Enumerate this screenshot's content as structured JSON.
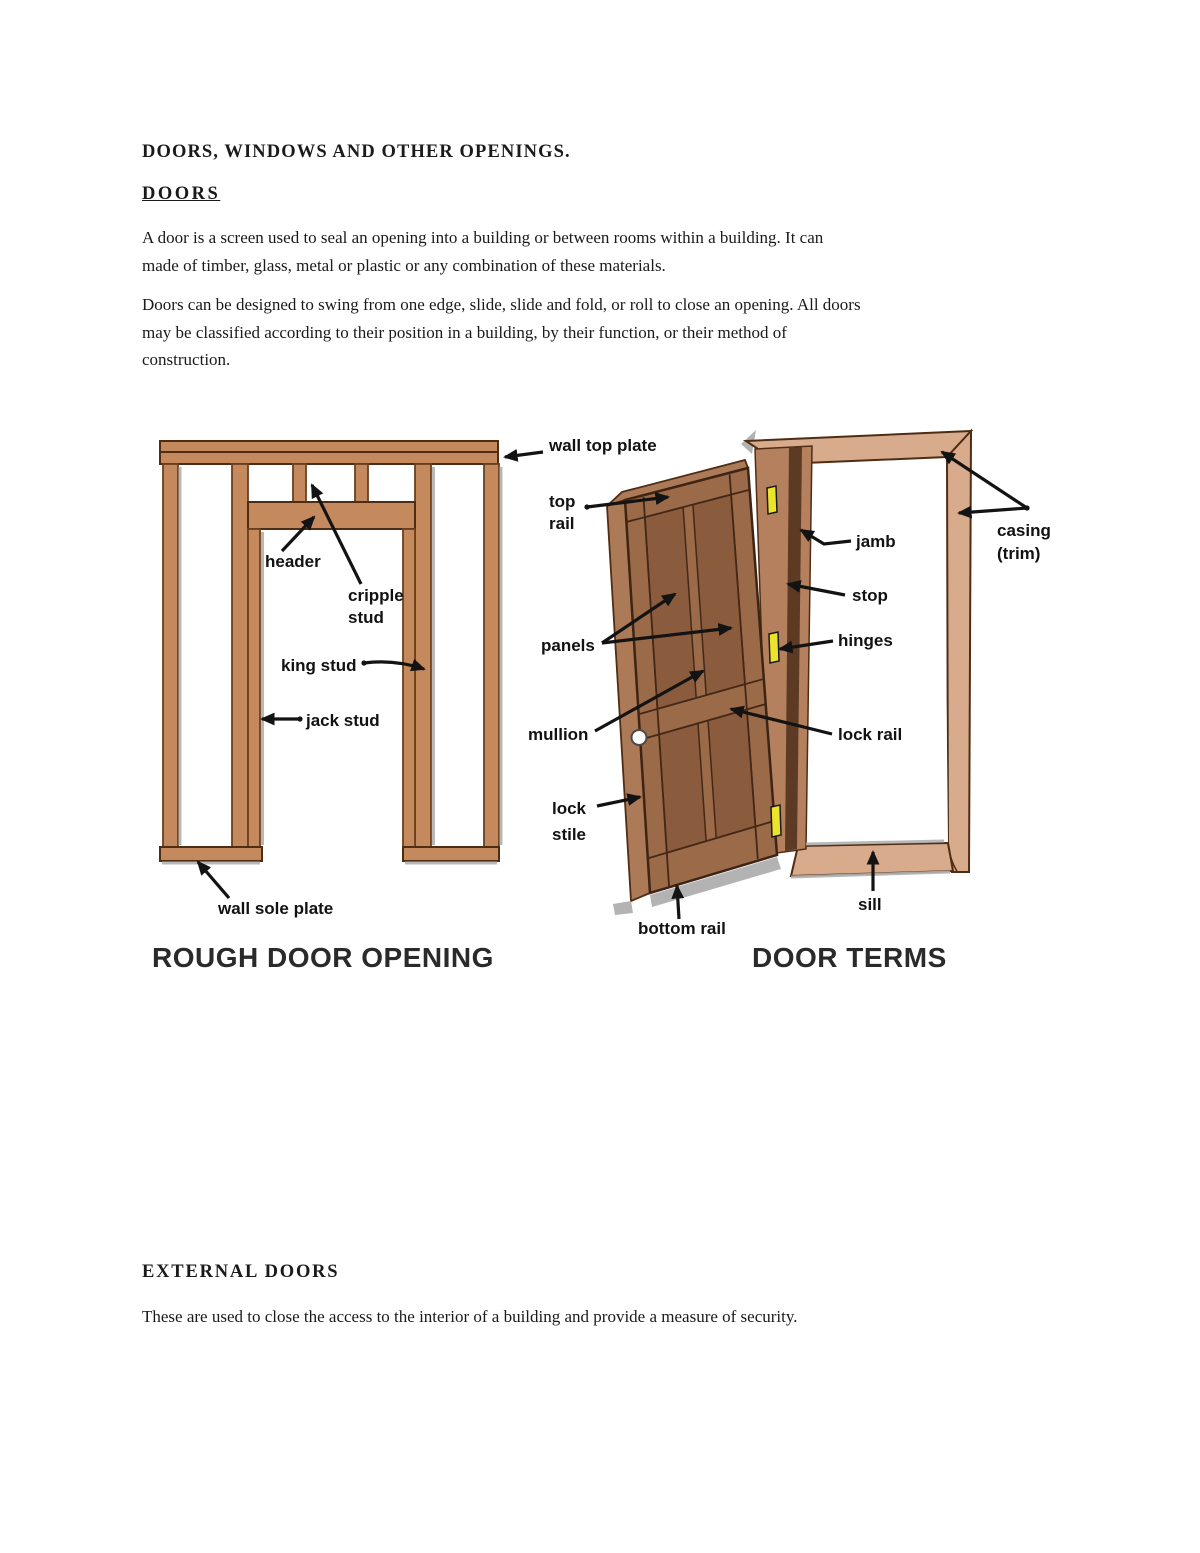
{
  "document": {
    "title": "DOORS, WINDOWS AND OTHER OPENINGS.",
    "heading_doors": "DOORS",
    "para1_lines": [
      "A door is a screen used to seal an opening into a building or between rooms within a building. It can",
      "made of timber, glass, metal or plastic or any combination of these materials."
    ],
    "para2_lines": [
      "Doors can be designed to swing from one edge, slide, slide and fold, or roll to close an opening. All doors",
      "may be classified according to their position in a building, by their function, or their method of",
      "construction."
    ],
    "heading_external": "EXTERNAL DOORS",
    "para3_lines": [
      "These are used to close the access to the interior of a building and provide a measure of security."
    ]
  },
  "figures": {
    "rough_door_opening": {
      "caption": "ROUGH DOOR OPENING",
      "labels": {
        "wall_top_plate": "wall top plate",
        "header": "header",
        "cripple_stud_line1": "cripple",
        "cripple_stud_line2": "stud",
        "king_stud": "king stud",
        "jack_stud": "jack stud",
        "wall_sole_plate": "wall sole plate"
      }
    },
    "door_terms": {
      "caption": "DOOR TERMS",
      "labels": {
        "top_rail_line1": "top",
        "top_rail_line2": "rail",
        "jamb": "jamb",
        "stop": "stop",
        "hinges": "hinges",
        "casing_line1": "casing",
        "casing_line2": "(trim)",
        "panels": "panels",
        "mullion": "mullion",
        "lock_rail": "lock rail",
        "lock_stile_line1": "lock",
        "lock_stile_line2": "stile",
        "bottom_rail": "bottom rail",
        "sill": "sill"
      }
    },
    "colors": {
      "stud_wood": "#c4895c",
      "casing_wood": "#d9ab8d",
      "jamb_wood": "#b5805d",
      "door_face": "#9a6a49",
      "door_edge": "#ad7a57",
      "panel_wood": "#8a5b3d",
      "stop_dark": "#5c3a23",
      "hinge_yellow": "#ece32b",
      "outline": "#4f2d15"
    }
  }
}
